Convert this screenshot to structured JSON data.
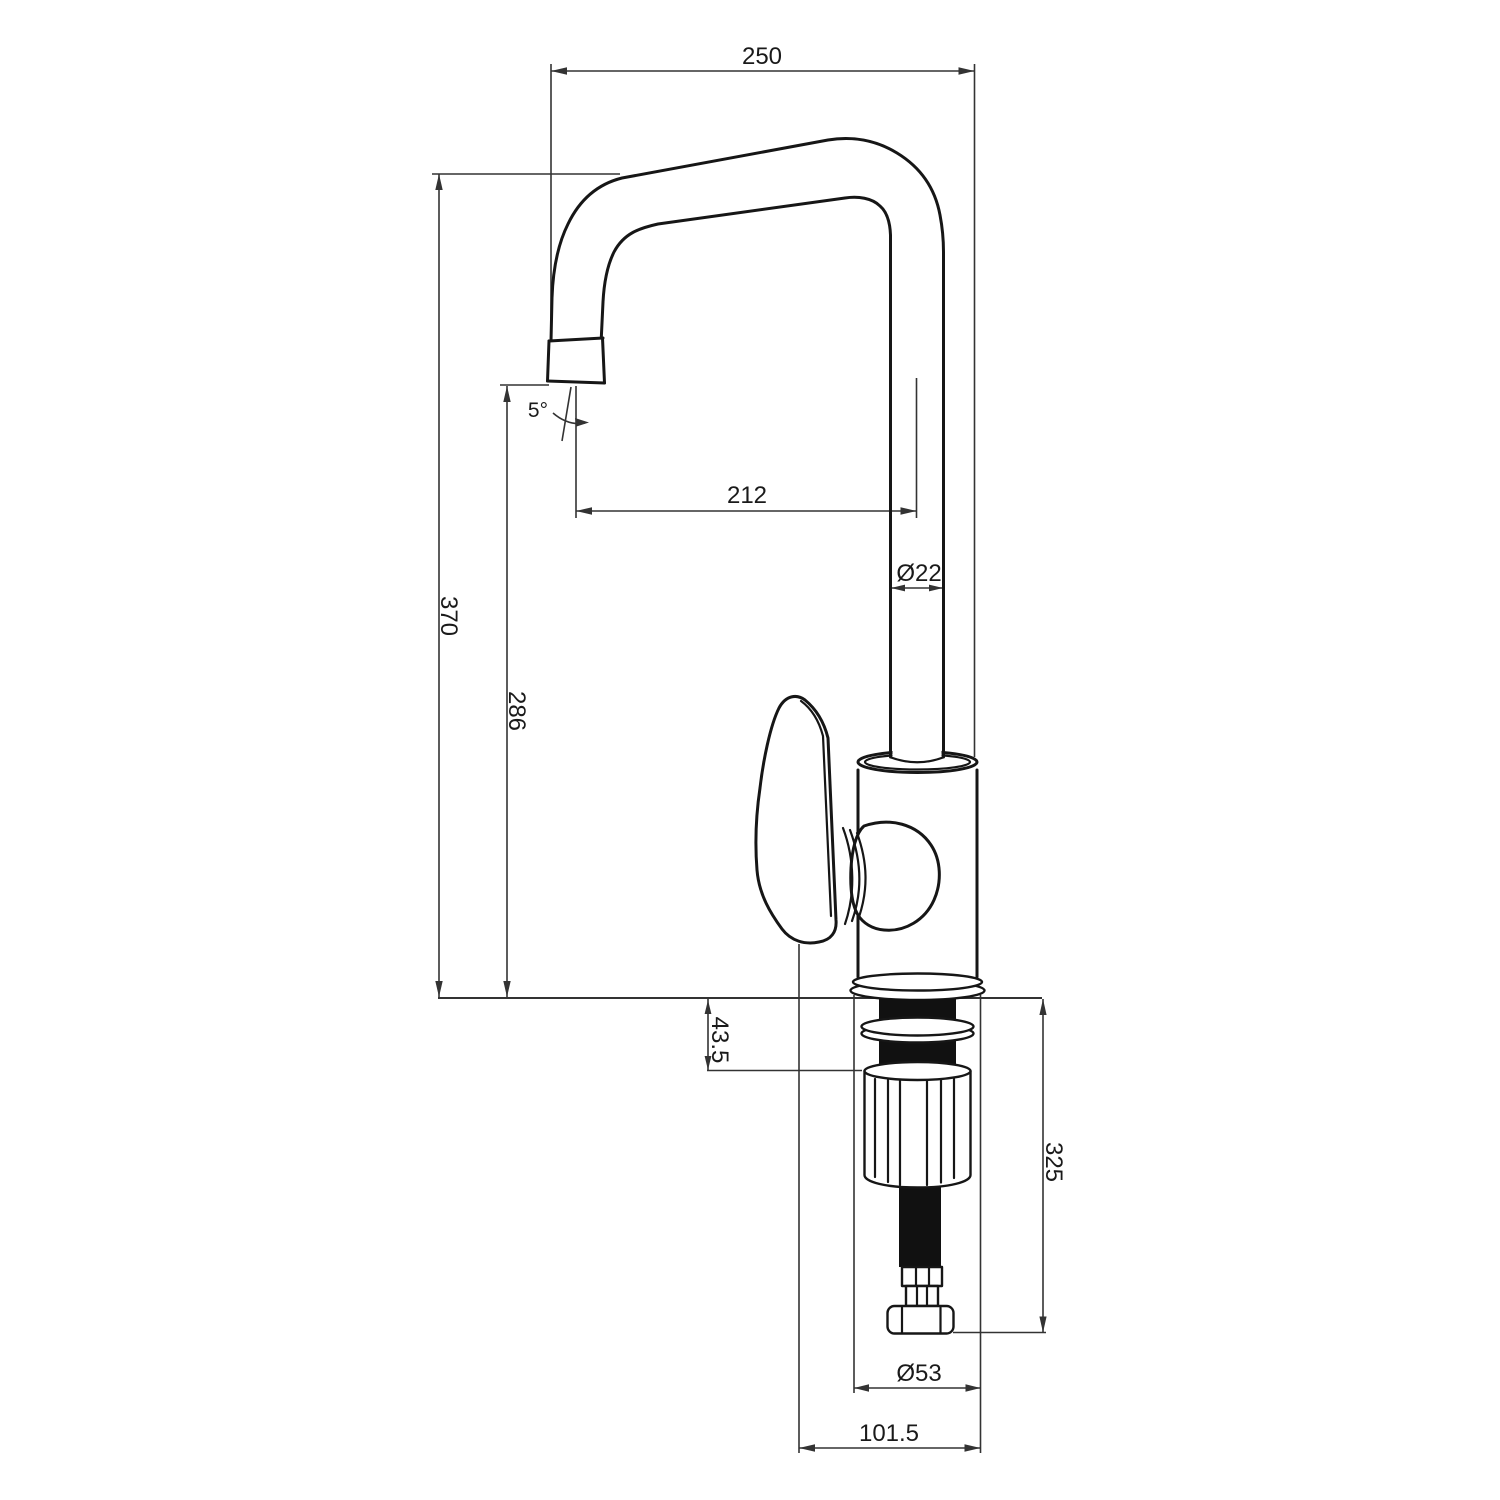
{
  "drawing": {
    "type": "faucet-installation-dimension-drawing",
    "background": "#ffffff",
    "line_color": "#161616",
    "dimension_color": "#333333"
  },
  "dimensions": {
    "overall_width": "250",
    "spout_reach": "212",
    "spout_pipe_diameter": "Ø22",
    "spout_tip_angle": "5°",
    "overall_height": "370",
    "spout_outlet_height": "286",
    "deck_thickness": "43.5",
    "below_deck_length": "325",
    "base_diameter": "Ø53",
    "front_clearance": "101.5"
  }
}
